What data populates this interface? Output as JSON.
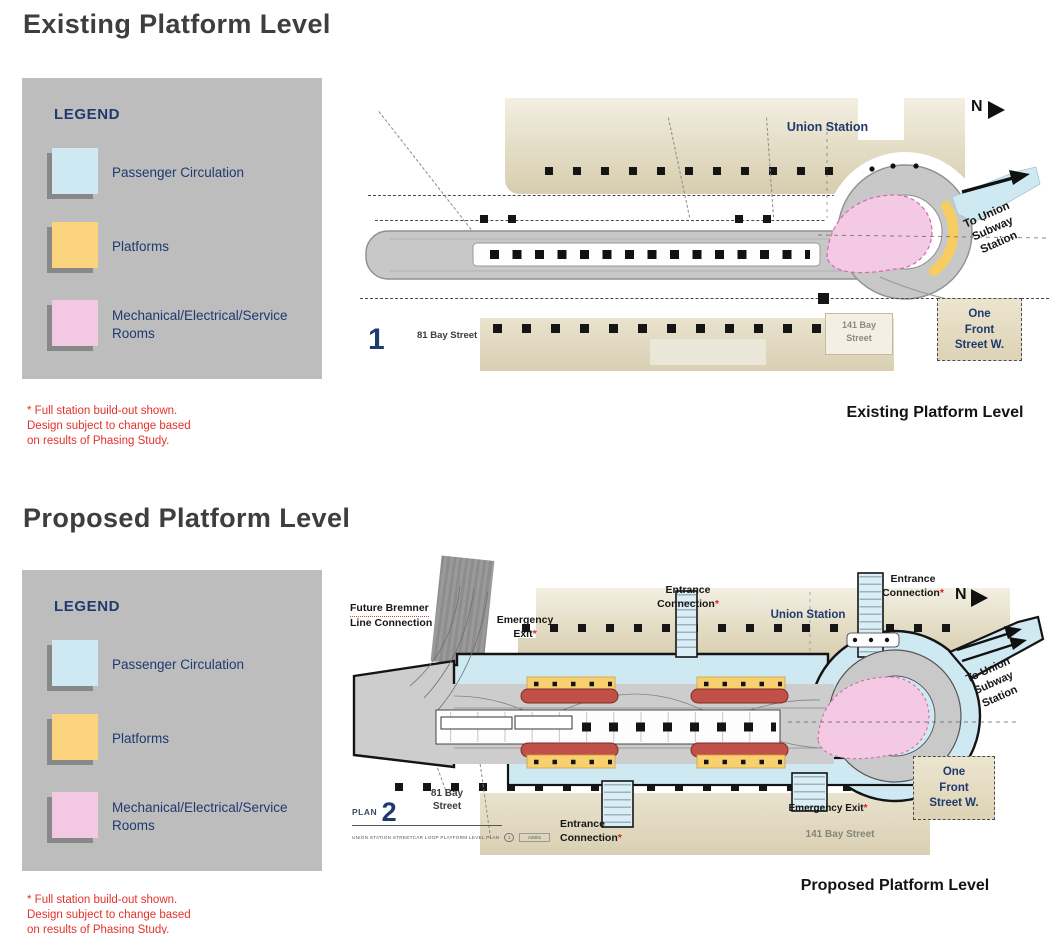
{
  "existing": {
    "title": "Existing Platform Level",
    "caption": "Existing Platform Level",
    "plan_number": "1"
  },
  "proposed": {
    "title": "Proposed Platform Level",
    "caption": "Proposed Platform Level",
    "plan_number": "2",
    "plan_prefix": "PLAN",
    "plan_subtitle": "UNION STATION STREETCAR LOOP PLATFORM LEVEL PLAN",
    "plan_ref_bubble": "1",
    "plan_ref_code": "A2001"
  },
  "legend": {
    "title": "LEGEND",
    "items": [
      {
        "name": "passenger-circulation",
        "label": "Passenger Circulation",
        "color": "#cfe9f2"
      },
      {
        "name": "platforms",
        "label": "Platforms",
        "color": "#fbd37e"
      },
      {
        "name": "mechanical-electrical-service-rooms",
        "label": "Mechanical/Electrical/Service Rooms",
        "color": "#f3c8e2"
      }
    ]
  },
  "note": {
    "lines": [
      "* Full station build-out shown.",
      "Design subject to change based",
      "on results of Phasing Study."
    ]
  },
  "map_labels": {
    "union_station": "Union Station",
    "north": "N",
    "to_union": [
      "To Union",
      "Subway",
      "Station"
    ],
    "bay81_plan1": "81 Bay Street",
    "bay81_plan2": [
      "81 Bay",
      "Street"
    ],
    "bay141_plan1": [
      "141 Bay",
      "Street"
    ],
    "bay141_plan2": "141 Bay Street",
    "one_front": [
      "One",
      "Front",
      "Street W."
    ],
    "future_bremner": [
      "Future Bremner",
      "Line Connection"
    ],
    "emergency": [
      "Emergency",
      "Exit"
    ],
    "emergency_exit": "Emergency Exit",
    "entrance": [
      "Entrance",
      "Connection"
    ],
    "asterisk": "*"
  },
  "colors": {
    "title_text": "#3e3e3e",
    "navy_text": "#1e3a6e",
    "note_red": "#e5312b",
    "legend_panel": "#bdbdbd",
    "passenger_circulation_blue": "#cfe9f2",
    "platform_yellow": "#f9d06e",
    "mech_service_pink": "#f3c8e2",
    "building_tan": "#d9d0b3",
    "tunnel_gray": "#c9c9c9",
    "streetcar_red": "#c05048",
    "column_black": "#151515"
  }
}
